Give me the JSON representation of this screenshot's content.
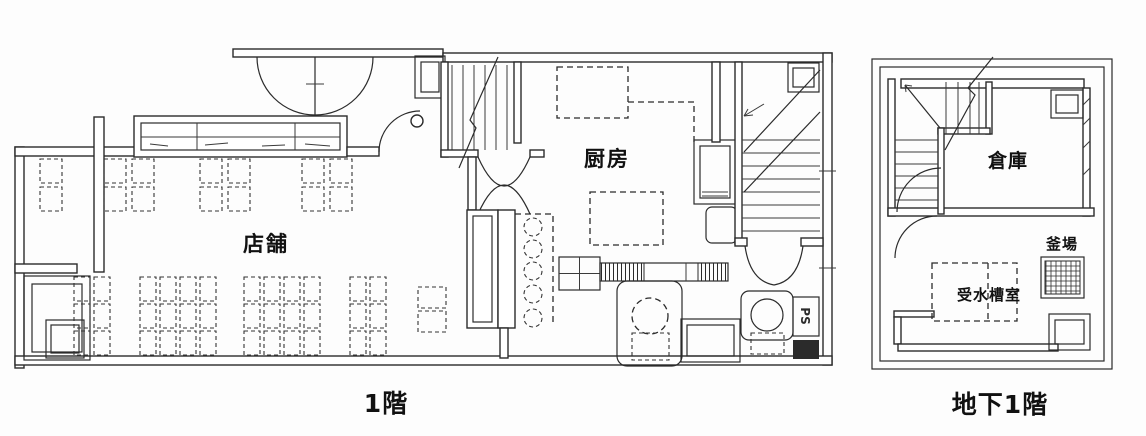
{
  "colors": {
    "ink": "#2b2b2b",
    "paper": "#fdfdfd"
  },
  "first_floor": {
    "caption": "1階",
    "labels": {
      "shop": "店舗",
      "kitchen": "厨房",
      "pipe_shaft": "PS"
    }
  },
  "basement": {
    "caption": "地下1階",
    "labels": {
      "storage": "倉庫",
      "boiler_pit": "釜場",
      "water_tank_room": "受水槽室"
    }
  }
}
